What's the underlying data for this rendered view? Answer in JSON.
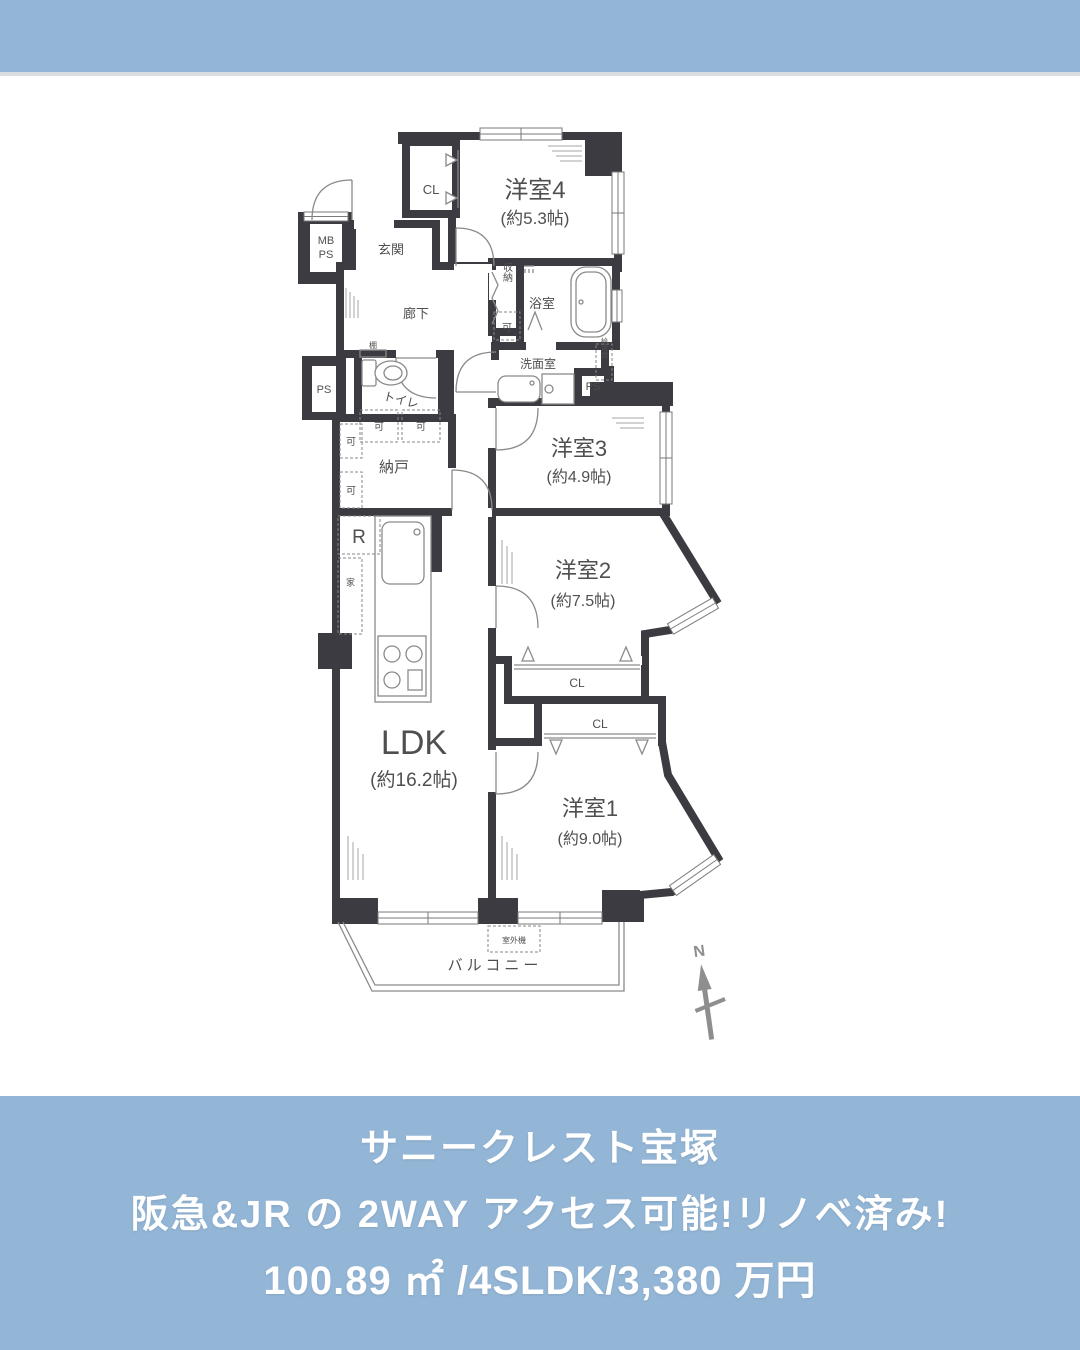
{
  "colors": {
    "accent_blue": "#94b6d6",
    "wall_dark": "#3b3b41",
    "fixture_gray": "#8a8a8a",
    "label_gray": "#4f4f4f",
    "compass_gray": "#8e8e8e",
    "caption_text": "#ffffff"
  },
  "floorplan": {
    "rooms": {
      "room4": {
        "name": "洋室4",
        "size": "(約5.3帖)"
      },
      "room3": {
        "name": "洋室3",
        "size": "(約4.9帖)"
      },
      "room2": {
        "name": "洋室2",
        "size": "(約7.5帖)"
      },
      "room1": {
        "name": "洋室1",
        "size": "(約9.0帖)"
      },
      "ldk": {
        "name": "LDK",
        "size": "(約16.2帖)"
      },
      "nando": "納戸",
      "genkan": "玄関",
      "rouka": "廊下",
      "bathroom": "浴室",
      "washroom": "洗面室",
      "toilet": "トイレ",
      "storage": "収納",
      "balcony": "バルコニー"
    },
    "labels": {
      "closet": "CL",
      "mb": "MB",
      "ps": "PS",
      "refrigerator": "R",
      "movable": "可",
      "shelf": "棚",
      "water_heater": "給湯器",
      "outdoor_unit": "室外機",
      "furniture": "家",
      "north": "N"
    }
  },
  "caption": {
    "building_name": "サニークレスト宝塚",
    "catch_copy": "阪急&JR の 2WAY アクセス可能!リノベ済み!",
    "specs": "100.89 ㎡ /4SLDK/3,380 万円"
  }
}
